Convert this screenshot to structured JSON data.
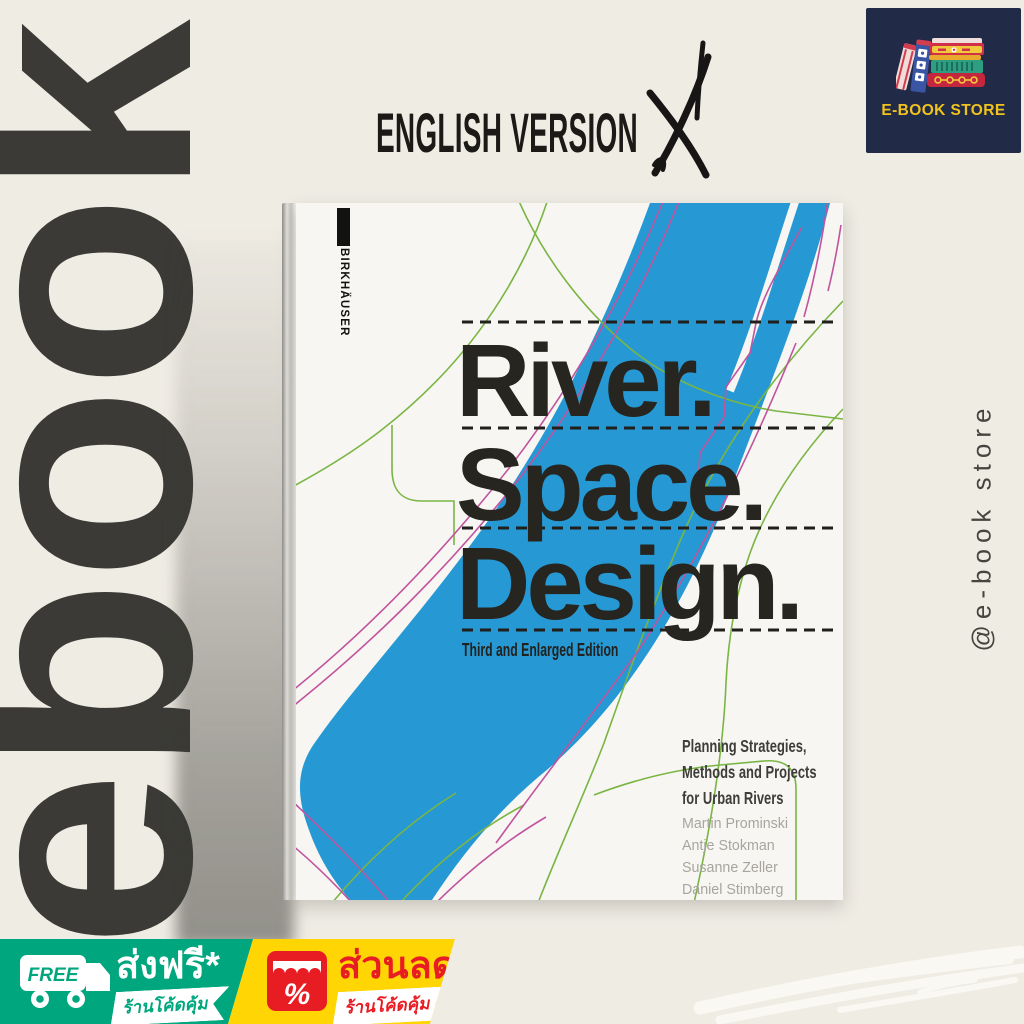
{
  "header": {
    "version_label": "ENGLISH VERSION"
  },
  "store_logo": {
    "name": "E-BOOK STORE"
  },
  "watermark": {
    "text": "ebook"
  },
  "social_handle": {
    "text": "@e-book store"
  },
  "book": {
    "publisher": "BIRKHÄUSER",
    "title_lines": [
      "River.",
      "Space.",
      "Design."
    ],
    "edition": "Third and Enlarged Edition",
    "subtitle_lines": [
      "Planning Strategies,",
      "Methods and Projects",
      "for Urban Rivers"
    ],
    "authors": [
      "Martin Prominski",
      "Antje Stokman",
      "Susanne Zeller",
      "Daniel Stimberg",
      "Hinnerk Voermanek",
      "Katarina Bajc",
      "Nengshi Zheng"
    ]
  },
  "badges": {
    "shipping": {
      "icon_label": "FREE",
      "title": "ส่งฟรี*",
      "ribbon": "ร้านโค้ดคุ้ม"
    },
    "discount": {
      "icon_symbol": "%",
      "title": "ส่วนลด",
      "ribbon": "ร้านโค้ดคุ้ม"
    }
  },
  "colors": {
    "background": "#efece4",
    "ink": "#3b3a36",
    "cover": "#f7f6f2",
    "river_blue": "#2699d4",
    "contour_green": "#7ab544",
    "contour_magenta": "#c0549e",
    "navy": "#212a46",
    "logo_gold": "#f0c31f",
    "badge_green": "#00a67e",
    "badge_yellow": "#ffd503",
    "badge_red": "#e81c23",
    "title_black": "#262520",
    "author_gray": "#a7a59e"
  }
}
